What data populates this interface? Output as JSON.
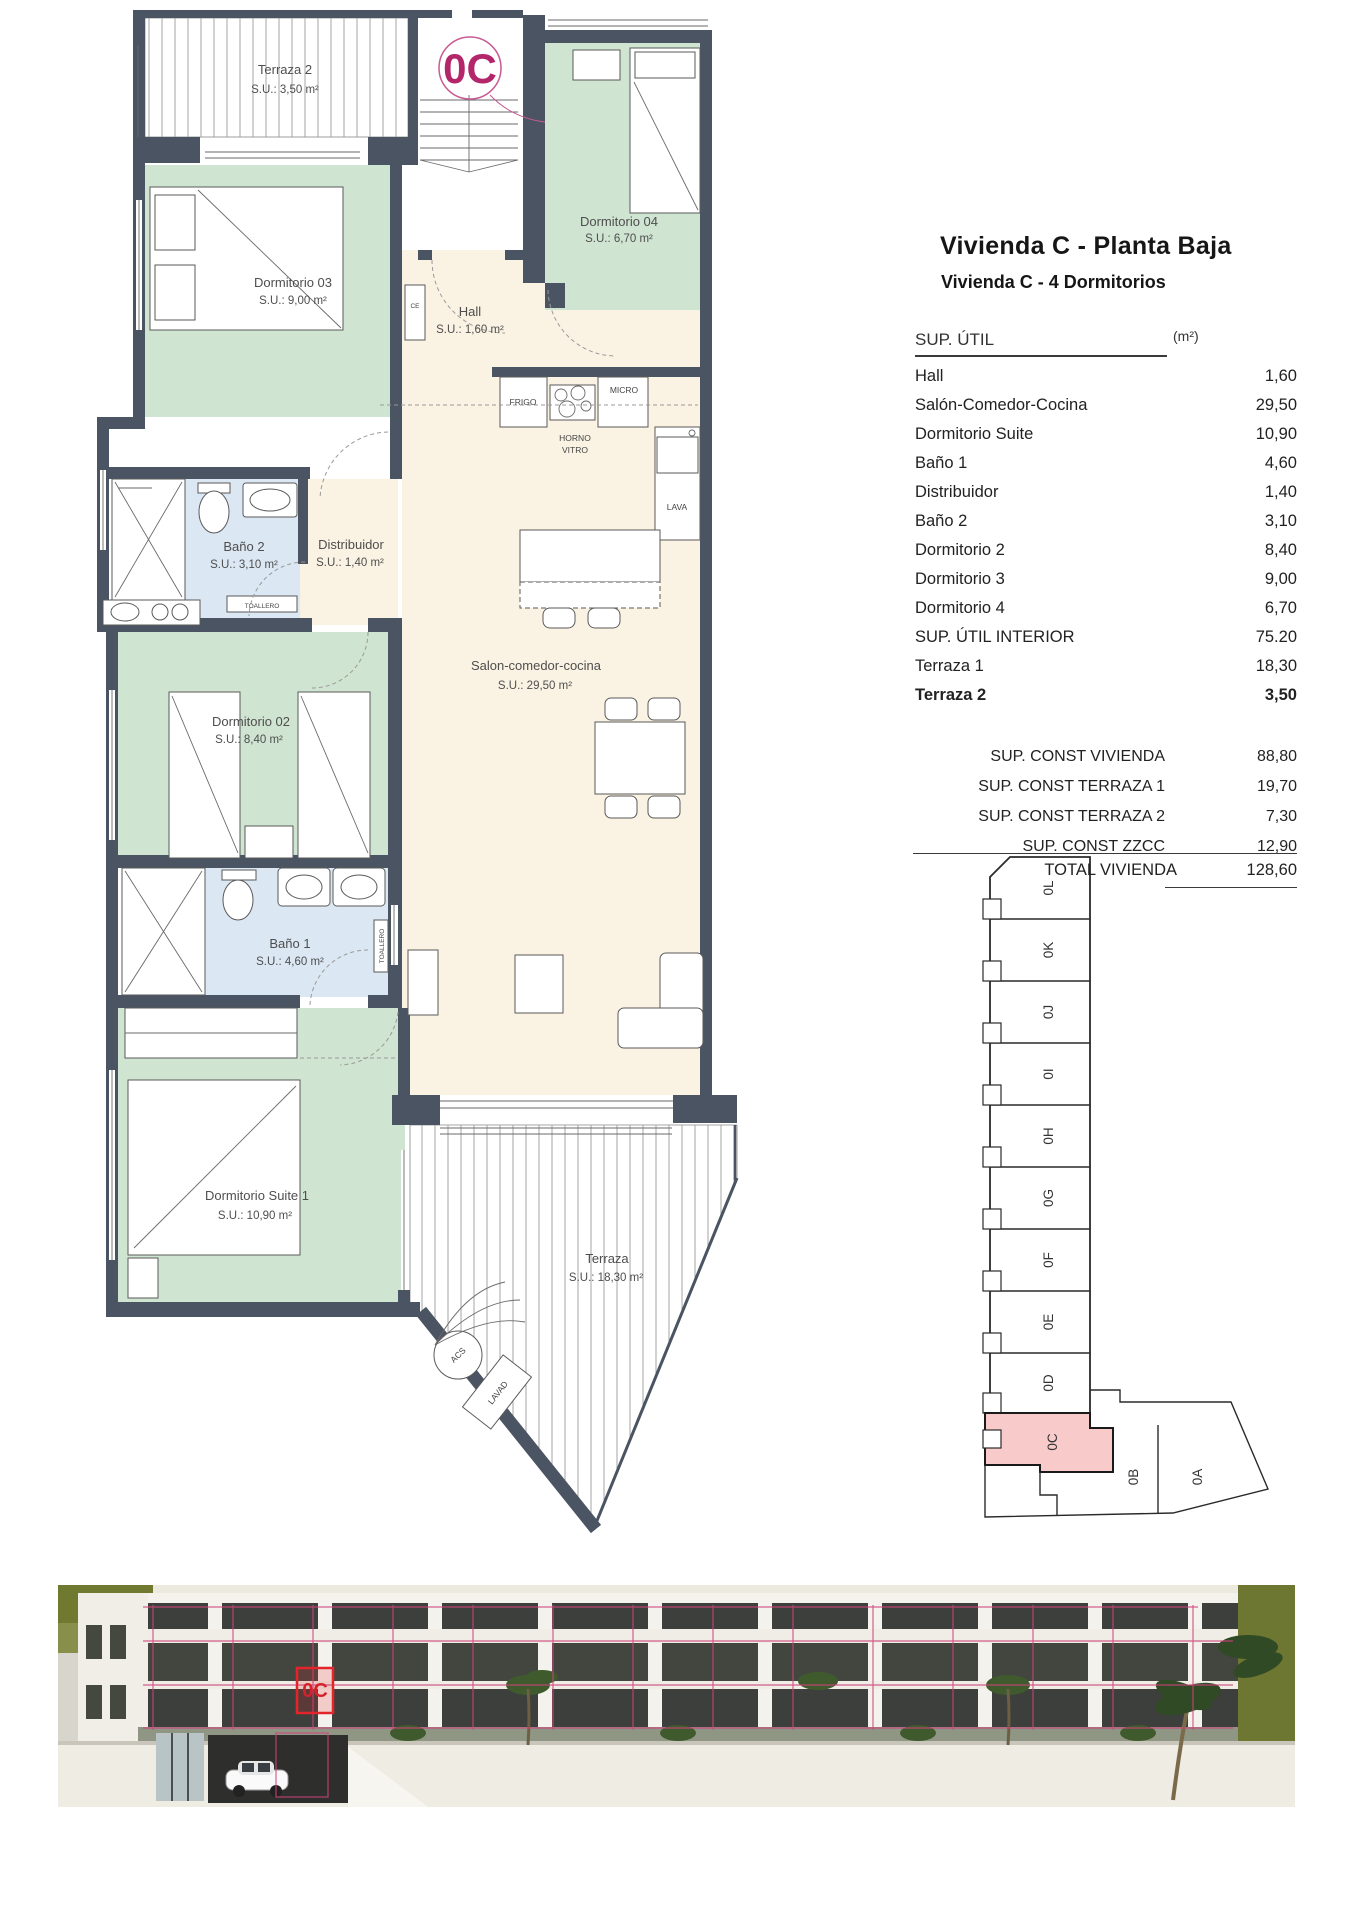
{
  "header": {
    "title": "Vivienda C - Planta Baja",
    "subtitle": "Vivienda C - 4 Dormitorios"
  },
  "area_table": {
    "title": "SUP. ÚTIL",
    "unit": "(m²)",
    "rows": [
      {
        "label": "Hall",
        "value": "1,60"
      },
      {
        "label": "Salón-Comedor-Cocina",
        "value": "29,50"
      },
      {
        "label": "Dormitorio Suite",
        "value": "10,90"
      },
      {
        "label": "Baño 1",
        "value": "4,60"
      },
      {
        "label": "Distribuidor",
        "value": "1,40"
      },
      {
        "label": "Baño 2",
        "value": "3,10"
      },
      {
        "label": "Dormitorio 2",
        "value": "8,40"
      },
      {
        "label": "Dormitorio 3",
        "value": "9,00"
      },
      {
        "label": "Dormitorio 4",
        "value": "6,70"
      },
      {
        "label": "SUP. ÚTIL INTERIOR",
        "value": "75.20"
      },
      {
        "label": "Terraza 1",
        "value": "18,30"
      },
      {
        "label": "Terraza 2",
        "value": "3,50"
      }
    ]
  },
  "summary_table": {
    "rows": [
      {
        "label": "SUP. CONST VIVIENDA",
        "value": "88,80"
      },
      {
        "label": "SUP. CONST TERRAZA 1",
        "value": "19,70"
      },
      {
        "label": "SUP. CONST TERRAZA 2",
        "value": "7,30"
      },
      {
        "label": "SUP. CONST ZZCC",
        "value": "12,90"
      }
    ],
    "total_label": "TOTAL VIVIENDA",
    "total_value": "128,60"
  },
  "floorplan": {
    "unit_badge": "0C",
    "rooms": {
      "terraza2": {
        "name": "Terraza 2",
        "area": "S.U.: 3,50 m²"
      },
      "dormitorio3": {
        "name": "Dormitorio 03",
        "area": "S.U.: 9,00 m²"
      },
      "dormitorio4": {
        "name": "Dormitorio 04",
        "area": "S.U.: 6,70 m²"
      },
      "hall": {
        "name": "Hall",
        "area": "S.U.: 1,60 m²"
      },
      "bano2": {
        "name": "Baño 2",
        "area": "S.U.: 3,10 m²"
      },
      "distribuidor": {
        "name": "Distribuidor",
        "area": "S.U.: 1,40 m²"
      },
      "salon": {
        "name": "Salon-comedor-cocina",
        "area": "S.U.: 29,50 m²"
      },
      "dormitorio2": {
        "name": "Dormitorio 02",
        "area": "S.U.: 8,40 m²"
      },
      "bano1": {
        "name": "Baño 1",
        "area": "S.U.: 4,60 m²"
      },
      "suite": {
        "name": "Dormitorio Suite 1",
        "area": "S.U.: 10,90 m²"
      },
      "terraza": {
        "name": "Terraza",
        "area": "S.U.: 18,30 m²"
      }
    },
    "fixtures": {
      "ce": "CE",
      "frigo": "FRIGO",
      "horno": "HORNO",
      "vitro": "VITRO",
      "micro": "MICRO",
      "lava": "LAVA",
      "toallero": "TOALLERO",
      "acs": "ACS",
      "lavad": "LAVAD"
    }
  },
  "keyplan": {
    "units": [
      "0L",
      "0K",
      "0J",
      "0I",
      "0H",
      "0G",
      "0F",
      "0E",
      "0D"
    ],
    "highlighted_unit": "0C",
    "lower_units": [
      "0B",
      "0A"
    ]
  },
  "render": {
    "unit_marker": "0C"
  },
  "colors": {
    "wall": "#4b5462",
    "bedroom_fill": "#cfe4d1",
    "bathroom_fill": "#dbe7f2",
    "living_fill": "#faf3e3",
    "keyplan_highlight": "#f8caca",
    "badge_magenta": "#b3266a",
    "marker_red": "#e3242b",
    "outline_pink": "#d0447c"
  }
}
